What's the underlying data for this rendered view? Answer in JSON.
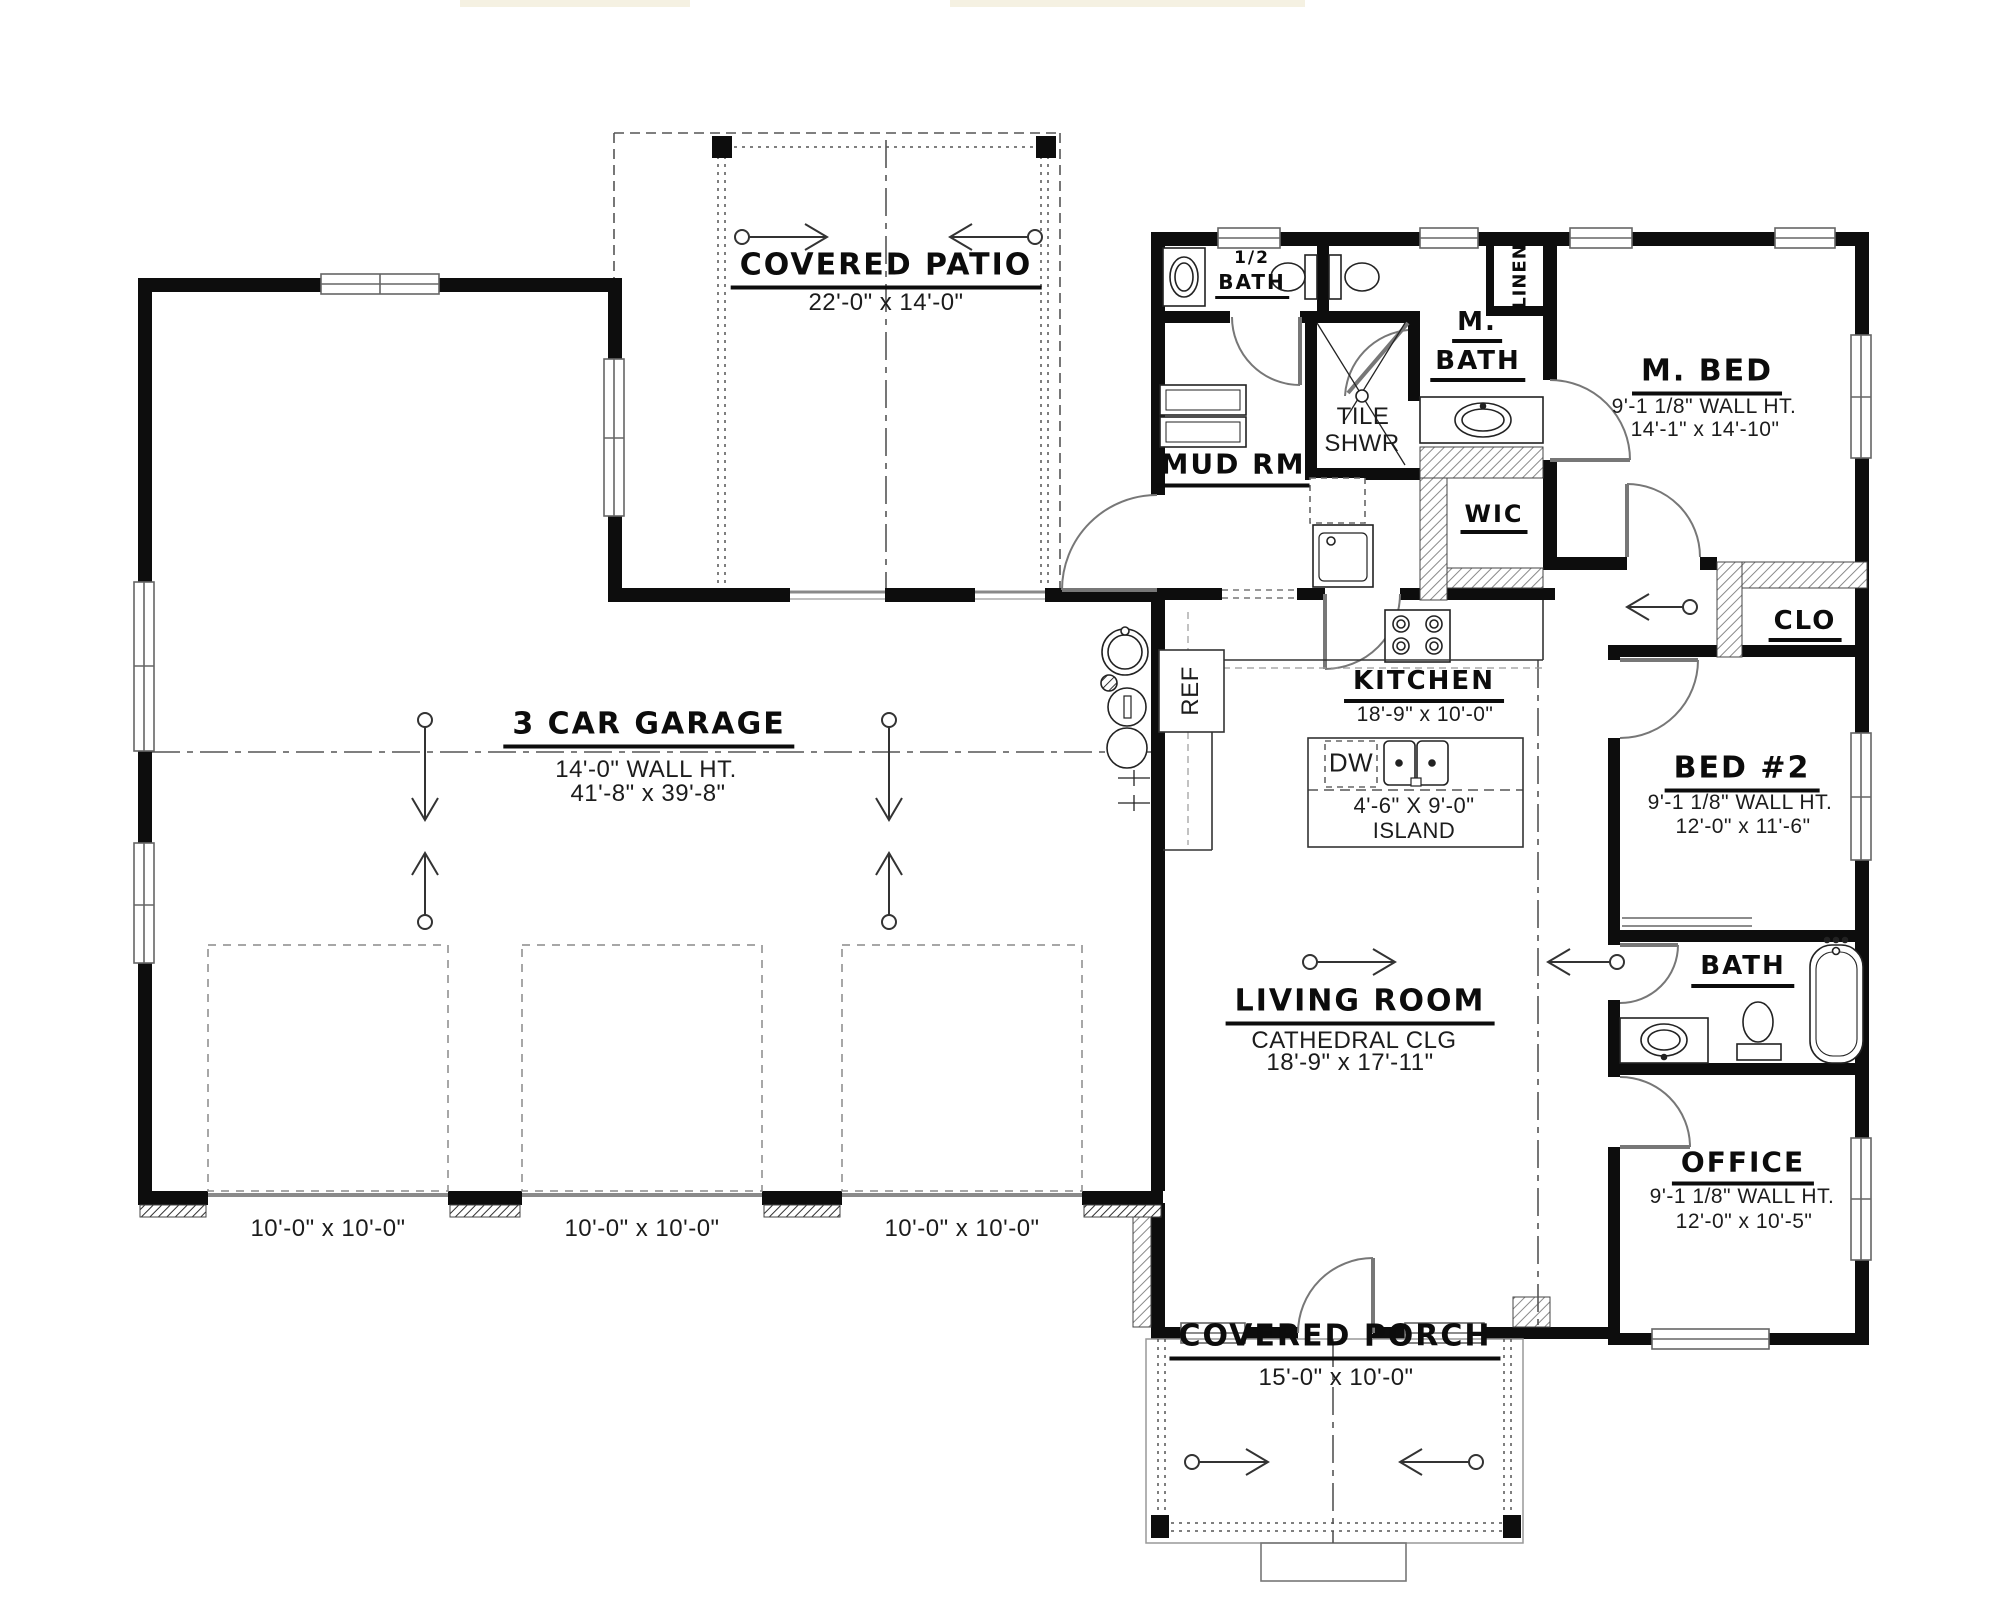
{
  "plan": {
    "patio": {
      "name": "COVERED PATIO",
      "dims": "22'-0\" x 14'-0\""
    },
    "garage": {
      "name": "3 CAR GARAGE",
      "wall_ht": "14'-0\" WALL HT.",
      "dims": "41'-8\" x 39'-8\"",
      "door_dims": [
        "10'-0\" x 10'-0\"",
        "10'-0\" x 10'-0\"",
        "10'-0\" x 10'-0\""
      ]
    },
    "half_bath": {
      "line1": "1/2",
      "line2": "BATH"
    },
    "linen": {
      "name": "LINEN"
    },
    "master_bath": {
      "line1": "M.",
      "line2": "BATH"
    },
    "master_bed": {
      "name": "M. BED",
      "wall_ht": "9'-1 1/8\" WALL HT.",
      "dims": "14'-1\" x 14'-10\""
    },
    "tile_shower": {
      "line1": "TILE",
      "line2": "SHWR"
    },
    "mud_room": {
      "name": "MUD RM"
    },
    "wic": {
      "name": "WIC"
    },
    "closet": {
      "name": "CLO"
    },
    "kitchen": {
      "name": "KITCHEN",
      "dims": "18'-9\" x 10'-0\""
    },
    "island": {
      "dims": "4'-6\" X 9'-0\"",
      "name": "ISLAND"
    },
    "appliances": {
      "fridge": "REF",
      "dishwasher": "DW"
    },
    "bed2": {
      "name": "BED #2",
      "wall_ht": "9'-1 1/8\" WALL HT.",
      "dims": "12'-0\" x 11'-6\""
    },
    "bath": {
      "name": "BATH"
    },
    "living": {
      "name": "LIVING ROOM",
      "ceiling": "CATHEDRAL CLG",
      "dims": "18'-9\" x 17'-11\""
    },
    "office": {
      "name": "OFFICE",
      "wall_ht": "9'-1 1/8\" WALL HT.",
      "dims": "12'-0\" x 10'-5\""
    },
    "porch": {
      "name": "COVERED PORCH",
      "dims": "15'-0\" x 10'-0\""
    },
    "colors": {
      "wall": "#0d0d0d",
      "line": "#666666",
      "centerline": "#555555"
    }
  }
}
